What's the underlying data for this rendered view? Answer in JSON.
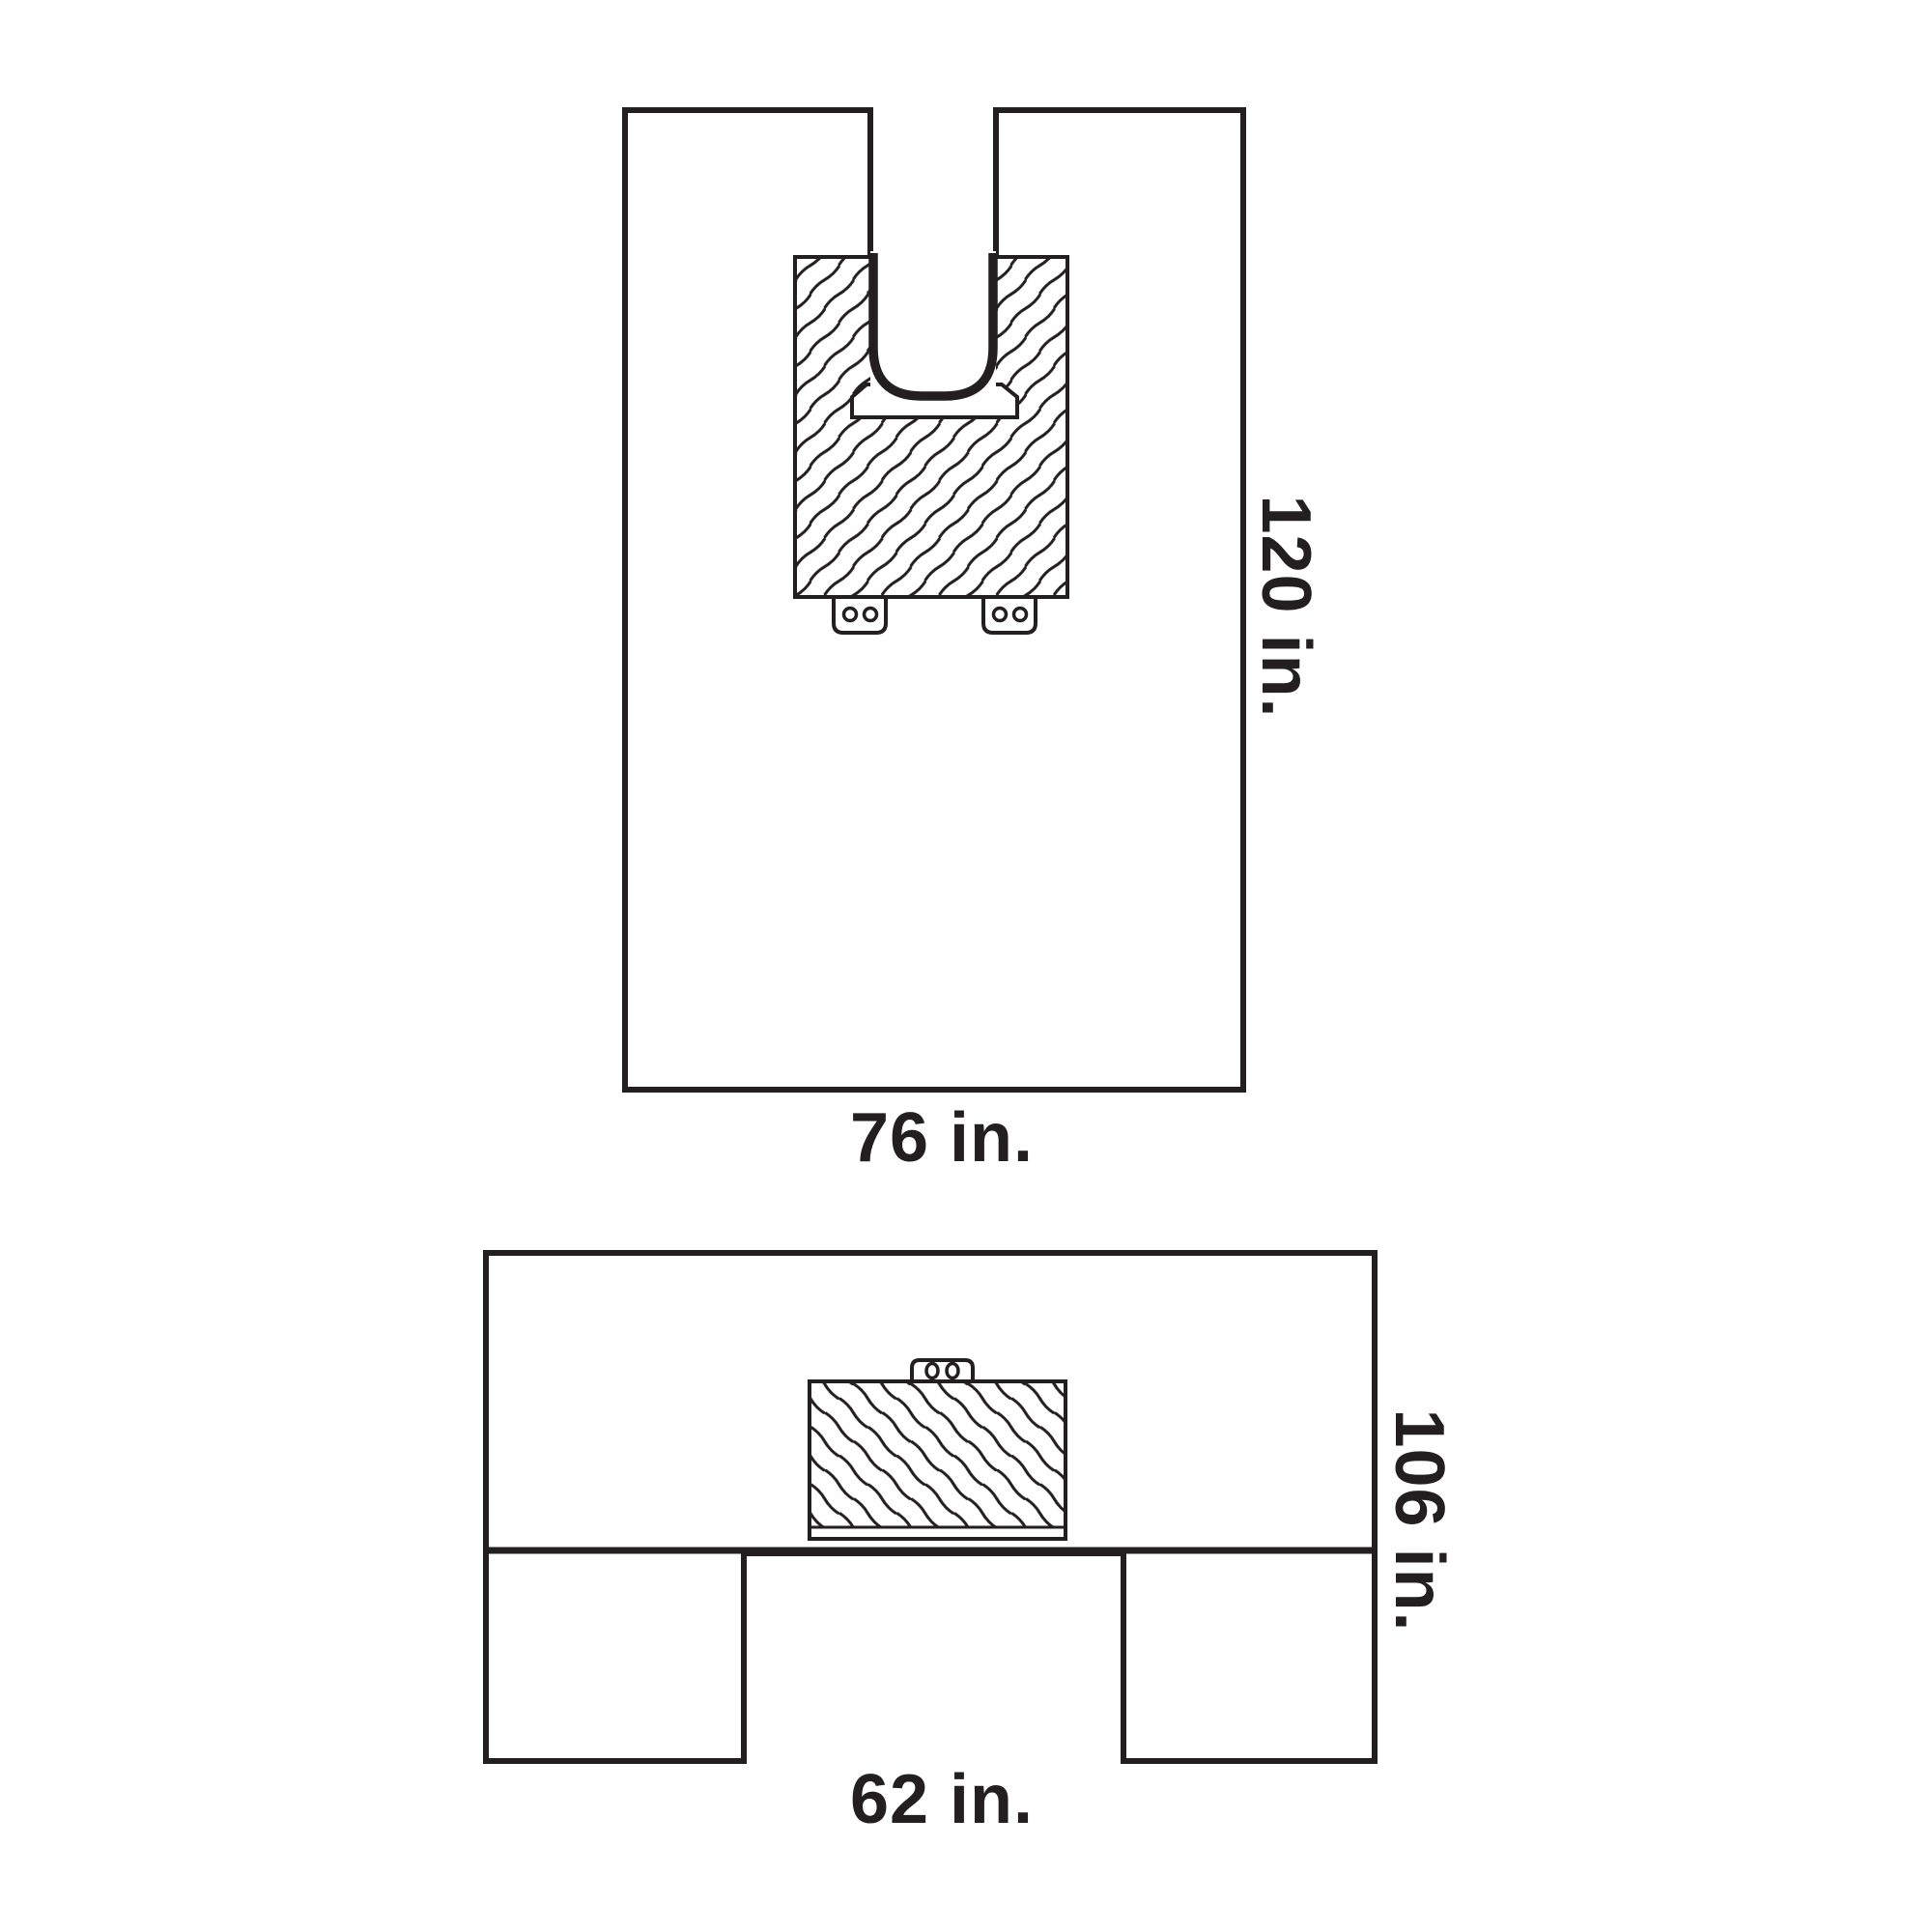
{
  "canvas": {
    "background": "#ffffff",
    "ink": "#231f20"
  },
  "top_figure": {
    "width_label": "76 in.",
    "height_label": "120 in."
  },
  "bottom_figure": {
    "width_label": "62 in.",
    "height_label": "106 in."
  }
}
